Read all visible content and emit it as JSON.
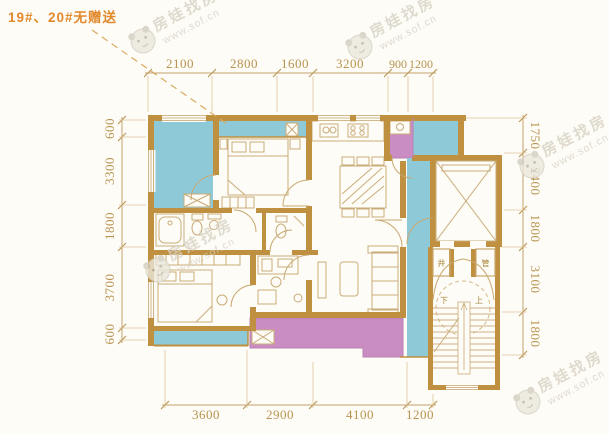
{
  "title": "19#、20#无赠送",
  "watermark": {
    "brand": "房娃找房",
    "url": "www.sof.cn"
  },
  "dimensions": {
    "top": [
      "2100",
      "2800",
      "1600",
      "3200",
      "900",
      "1200"
    ],
    "bottom": [
      "3600",
      "2900",
      "4100",
      "1200"
    ],
    "left": [
      "600",
      "3300",
      "1800",
      "3700",
      "600"
    ],
    "right": [
      "1750",
      "2400",
      "1800",
      "3100",
      "1800"
    ]
  },
  "plan_labels": {
    "shaft": "井",
    "pipe": "管",
    "up": "上",
    "down": "下"
  },
  "colors": {
    "wall": "#bf9040",
    "line": "#c9a870",
    "dimension": "#b8934f",
    "highlight_cyan": "#8ec9d8",
    "highlight_pink": "#ca8dc3",
    "title_orange": "#e2892c",
    "background": "#fefcf7",
    "watermark": "#d7d1c3"
  }
}
